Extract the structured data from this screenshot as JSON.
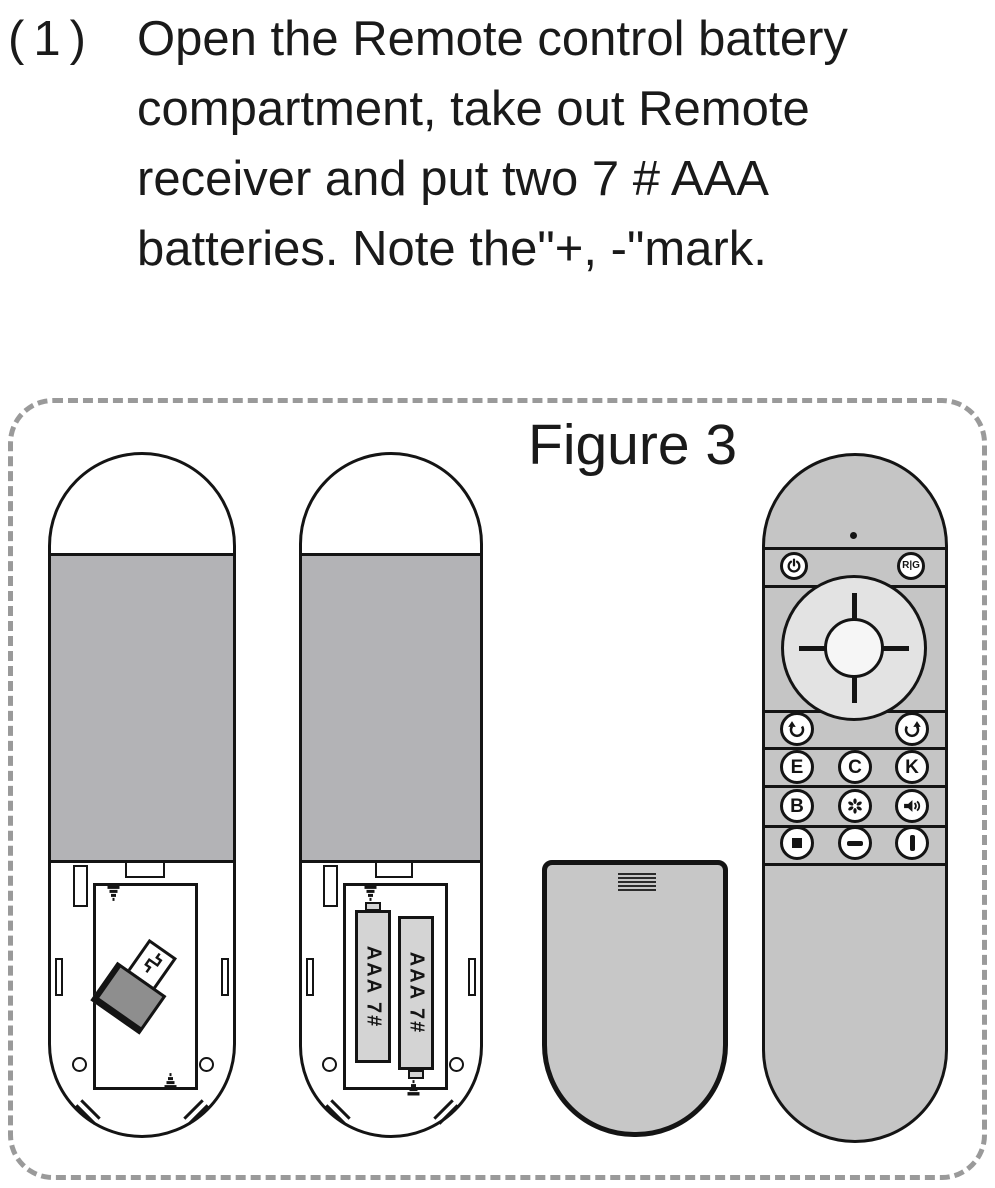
{
  "instruction": {
    "marker": "(1)",
    "lines": [
      "Open the Remote control battery",
      "compartment, take out Remote",
      "receiver and put two 7 # AAA",
      "batteries. Note the\"+, -\"mark."
    ]
  },
  "figure": {
    "label": "Figure 3",
    "batteries": {
      "left": "AAA 7#",
      "right": "AAA 7#"
    },
    "remote_front": {
      "rg": "R|G",
      "e": "E",
      "c": "C",
      "k": "K",
      "b": "B"
    },
    "icons": {
      "power": "power-icon",
      "back": "back-arrow-icon",
      "refresh": "refresh-icon",
      "apps": "flower-icon",
      "voice": "speaker-volume-icon",
      "mouse": "square-icon",
      "volume_down": "minus-icon",
      "volume_up": "bar-icon",
      "receiver": "usb-receiver-icon",
      "screw": "screw-icon"
    },
    "colors": {
      "back_panel_gray": "#b3b3b6",
      "front_body_gray": "#c5c5c5",
      "cover_gray": "#c7c7c7",
      "dpad_ring": "#e3e3e3",
      "dpad_center": "#f6f6f6",
      "battery_fill": "#d4d4d4",
      "outline": "#141414",
      "dashed_border": "#9a9a9a"
    }
  }
}
